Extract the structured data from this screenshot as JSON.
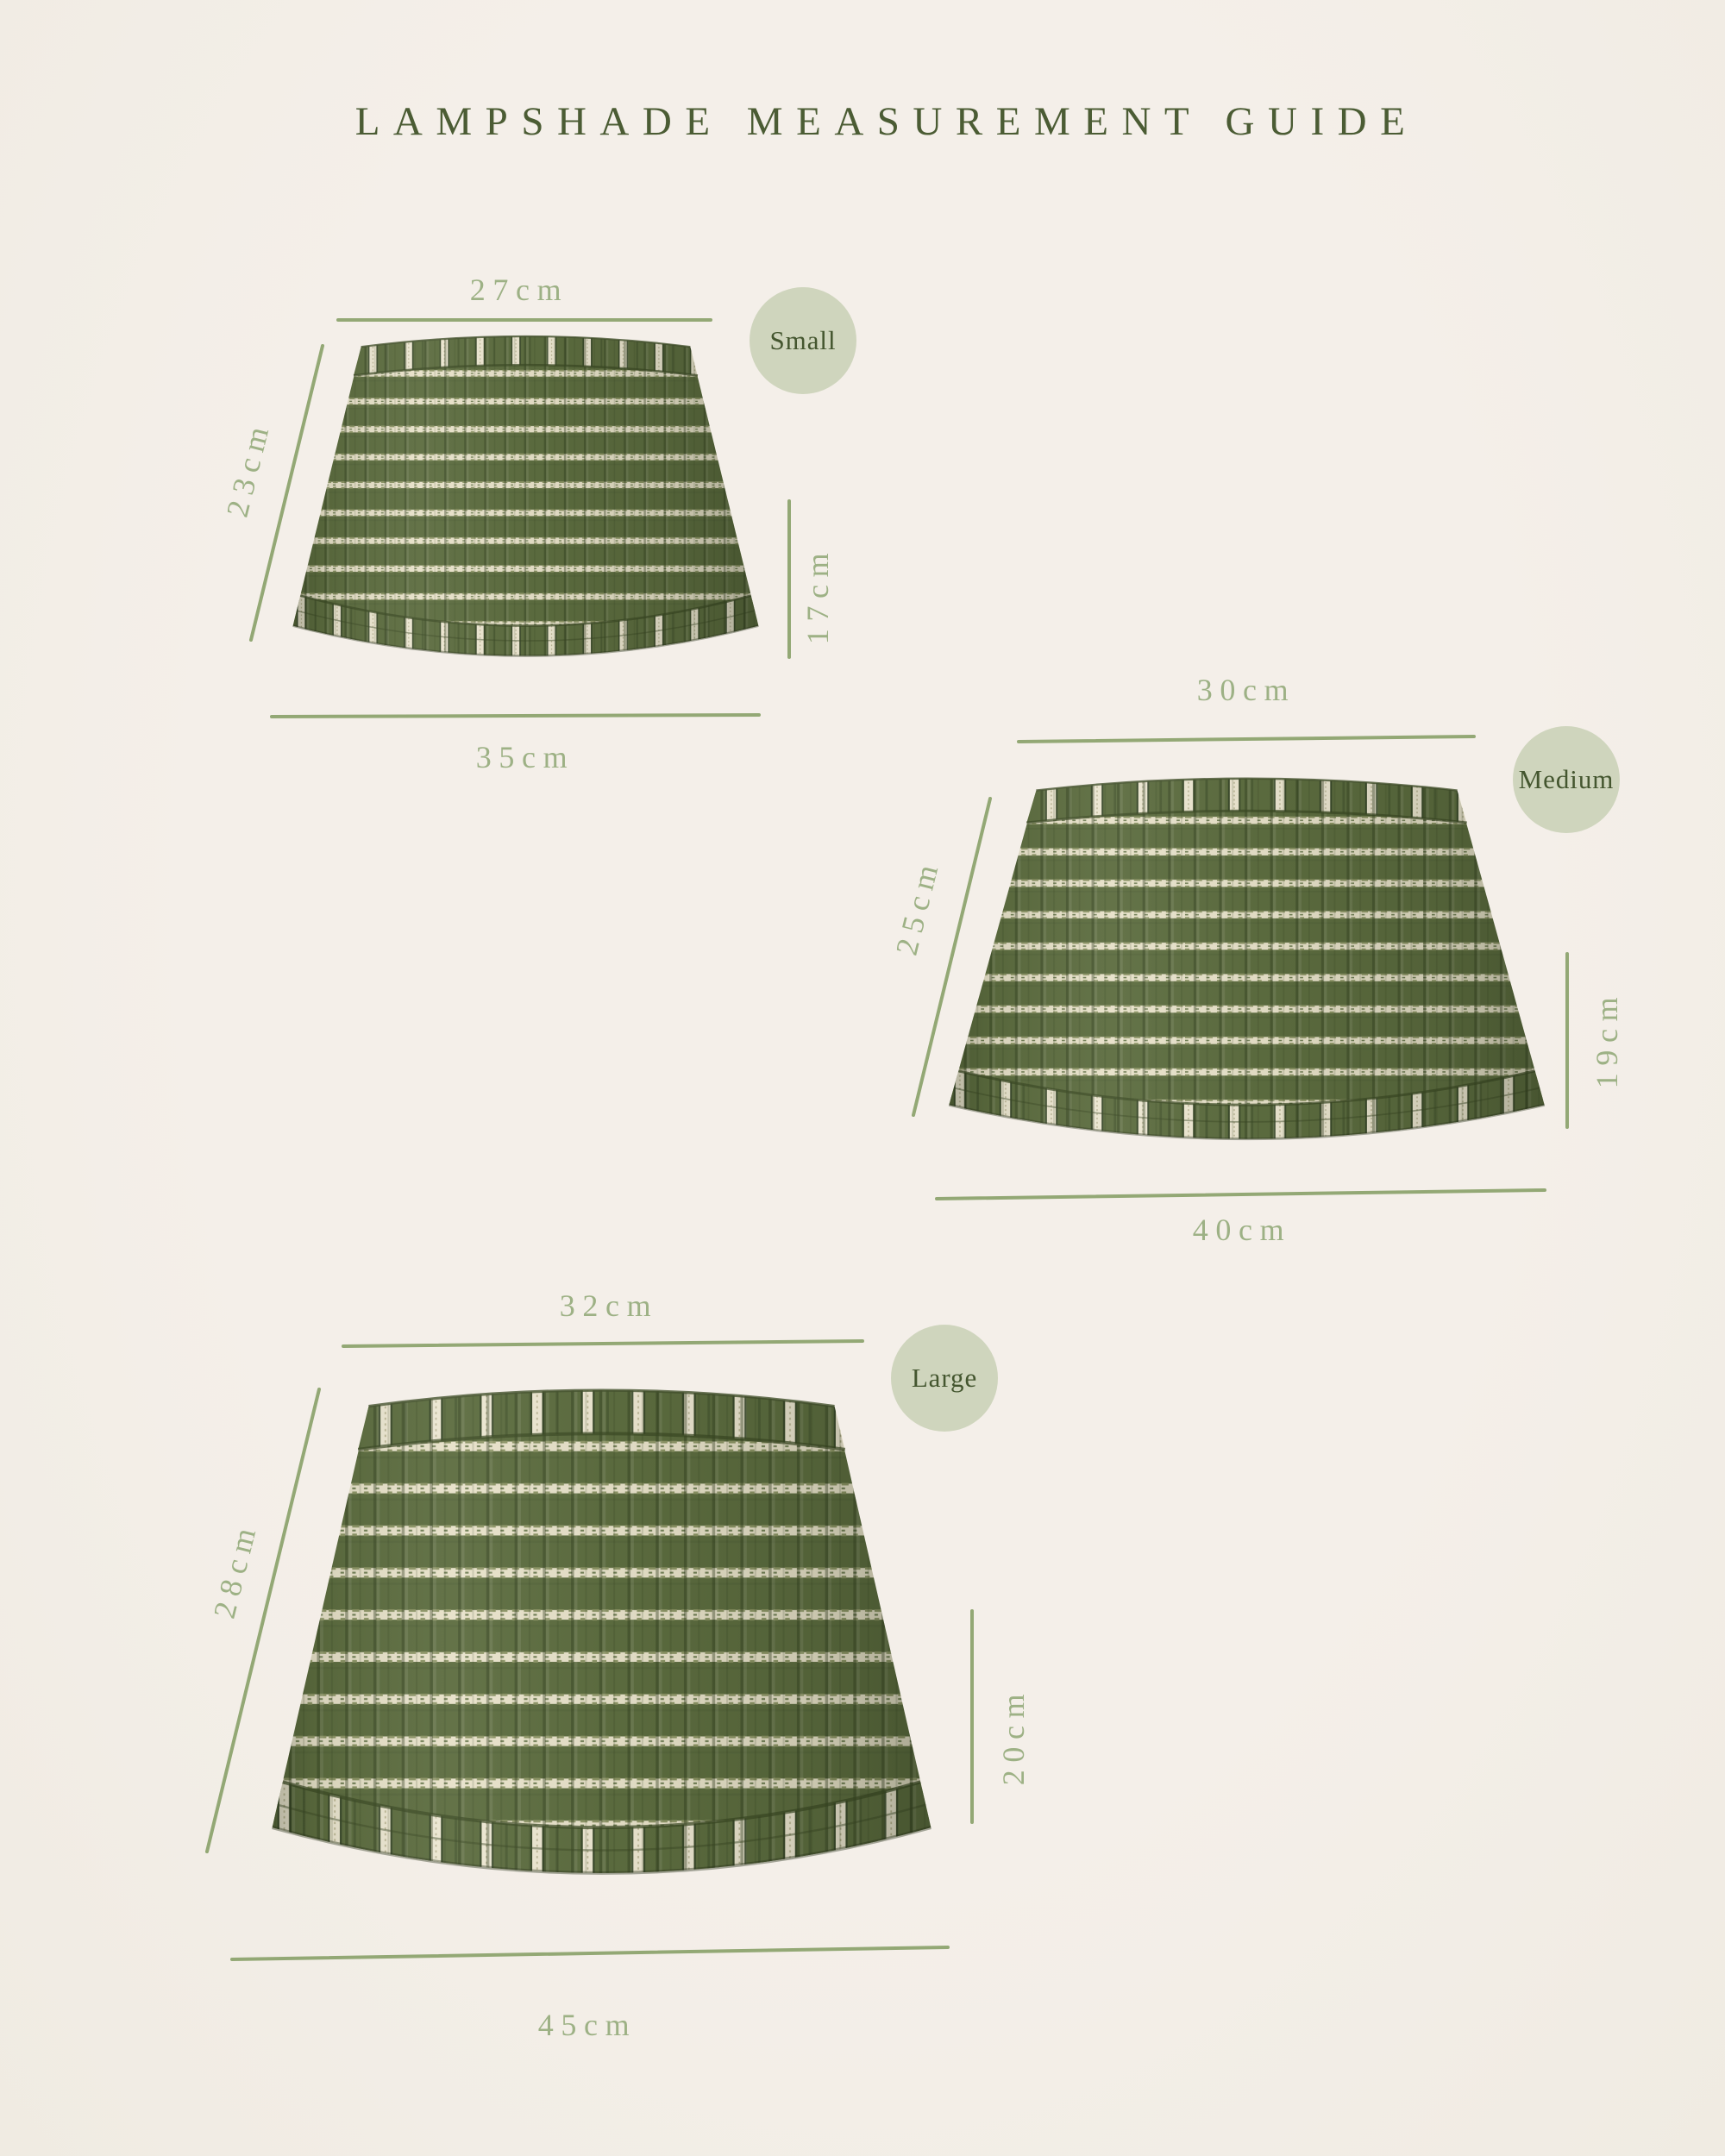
{
  "title": "LAMPSHADE MEASUREMENT GUIDE",
  "unit": "cm",
  "colors": {
    "background": "#f3eee8",
    "dimension_line": "#93a875",
    "dimension_label": "#9db185",
    "title_text": "#4b5c34",
    "badge_background": "#cfd5bd",
    "badge_text": "#44562f",
    "fabric_green": "#5c6c3f",
    "fabric_pleat_shadow": "#2c3a1b",
    "fabric_stripe_cream": "#e7e1c9"
  },
  "sizes": [
    {
      "name": "Small",
      "top_width": "27cm",
      "slant_height": "23cm",
      "drop_height": "17cm",
      "bottom_width": "35cm"
    },
    {
      "name": "Medium",
      "top_width": "30cm",
      "slant_height": "25cm",
      "drop_height": "19cm",
      "bottom_width": "40cm"
    },
    {
      "name": "Large",
      "top_width": "32cm",
      "slant_height": "28cm",
      "drop_height": "20cm",
      "bottom_width": "45cm"
    }
  ]
}
